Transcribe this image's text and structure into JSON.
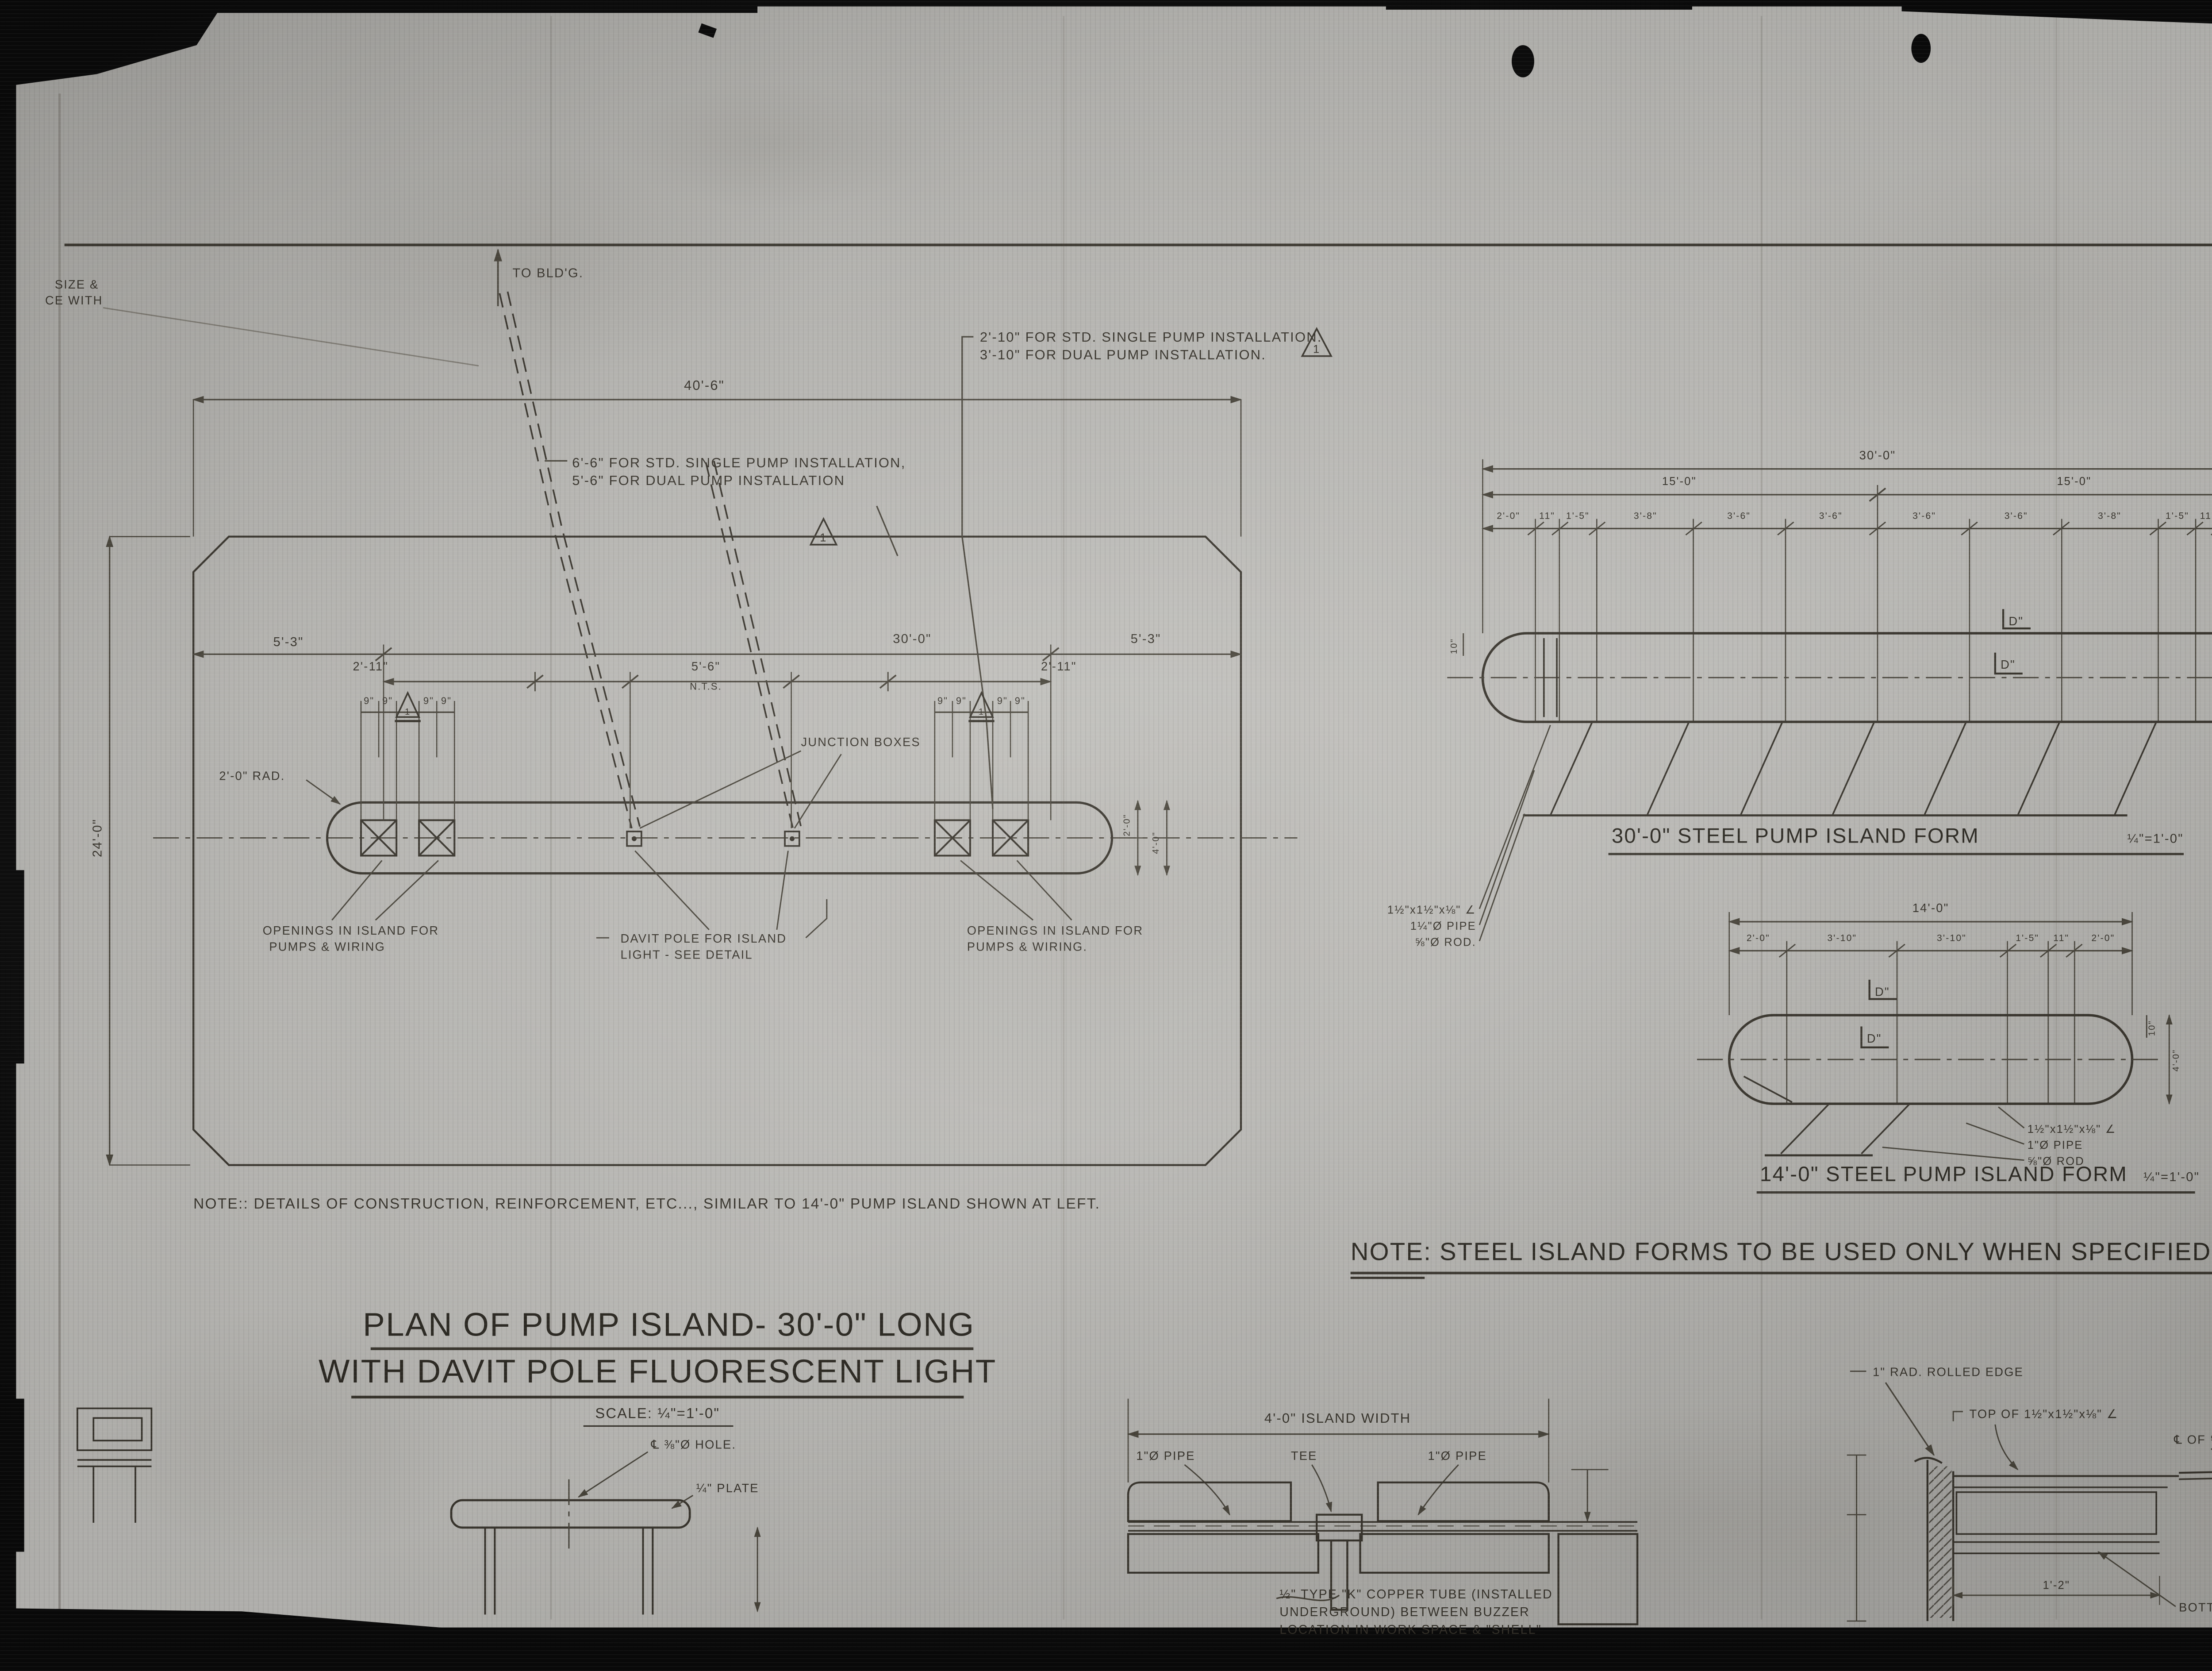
{
  "film": {
    "page_label": "2 of/de"
  },
  "margin_notes": {
    "cut_line1": "SIZE &",
    "cut_line2": "CE WITH",
    "to_building": "TO BLD'G."
  },
  "plan": {
    "annotations": {
      "pump_offset_top_line1": "2'-10\" FOR STD. SINGLE PUMP INSTALLATION.",
      "pump_offset_top_line2": "3'-10\" FOR DUAL PUMP INSTALLATION.",
      "pump_offset_left_line1": "6'-6\" FOR STD. SINGLE PUMP INSTALLATION,",
      "pump_offset_left_line2": "5'-6\" FOR DUAL PUMP INSTALLATION",
      "rev_triangle": "1",
      "junction_boxes": "JUNCTION BOXES",
      "davit_line1": "DAVIT POLE FOR ISLAND",
      "davit_line2": "LIGHT - SEE DETAIL",
      "openings_left_line1": "OPENINGS IN ISLAND FOR",
      "openings_left_line2": "PUMPS & WIRING",
      "openings_right_line1": "OPENINGS IN ISLAND FOR",
      "openings_right_line2": "PUMPS & WIRING.",
      "radius": "2'-0\" RAD."
    },
    "dims": {
      "overall": "40'-6\"",
      "left_end": "5'-3\"",
      "island_length": "30'-0\"",
      "right_end": "5'-3\"",
      "pump_left": "2'-11\"",
      "davit_spacing": "5'-6\"",
      "nts": "N.T.S.",
      "pump_right": "2'-11\"",
      "nine": "9\"",
      "depth": "24'-0\"",
      "island_half": "2'-0\"",
      "island_width": "4'-0\""
    },
    "note": "NOTE:: DETAILS OF CONSTRUCTION, REINFORCEMENT, ETC..., SIMILAR TO 14'-0\" PUMP ISLAND SHOWN AT LEFT.",
    "title_line1": "PLAN OF PUMP ISLAND- 30'-0\" LONG",
    "title_line2": "WITH DAVIT POLE FLUORESCENT LIGHT",
    "title_scale": "SCALE: ¼\"=1'-0\""
  },
  "form30": {
    "dims": {
      "total": "30'-0\"",
      "half_left": "15'-0\"",
      "half_right": "15'-0\"",
      "segs": [
        "2'-0\"",
        "11\"",
        "1'-5\"",
        "3'-8\"",
        "3'-6\"",
        "3'-6\"",
        "3'-6\"",
        "3'-6\"",
        "3'-8\"",
        "1'-5\"",
        "11\"",
        "2'-0\""
      ],
      "side_left": "10\"",
      "side_right": "10\"",
      "height": "4'-0\""
    },
    "section_mark": "D\"",
    "labels": {
      "angle": "1½\"x1½\"x⅛\" ∠",
      "pipe": "1¼\"Ø PIPE",
      "rod": "⅝\"Ø ROD."
    },
    "caption": "30'-0\" STEEL PUMP ISLAND FORM",
    "caption_scale": "¼\"=1'-0\""
  },
  "form14": {
    "dims": {
      "total": "14'-0\"",
      "segs": [
        "2'-0\"",
        "3'-10\"",
        "3'-10\"",
        "1'-5\"",
        "11\"",
        "2'-0\""
      ],
      "side_right": "10\"",
      "height": "4'-0\""
    },
    "section_mark": "D\"",
    "labels": {
      "angle": "1½\"x1½\"x⅛\" ∠",
      "pipe": "1\"Ø PIPE",
      "rod": "⅝\"Ø ROD"
    },
    "caption": "14'-0\" STEEL PUMP ISLAND FORM",
    "caption_scale": "¼\"=1'-0\""
  },
  "steel_note": "NOTE: STEEL ISLAND FORMS TO BE USED ONLY WHEN SPECIFIED.",
  "detail_pole": {
    "hole": "℄ ⅜\"Ø HOLE.",
    "plate": "¼\" PLATE"
  },
  "detail_section": {
    "width": "4'-0\" ISLAND WIDTH",
    "pipe_left": "1\"Ø PIPE",
    "tee": "TEE",
    "pipe_right": "1\"Ø PIPE",
    "note_line1": "½\" TYPE \"K\" COPPER TUBE (INSTALLED",
    "note_line2": "UNDERGROUND) BETWEEN BUZZER",
    "note_line3": "LOCATION IN WORK SPACE & \"SHELL\""
  },
  "detail_edge": {
    "rolled_edge": "1\" RAD. ROLLED EDGE",
    "top_of_angle": "TOP OF 1½\"x1½\"x⅛\" ∠",
    "rod_cl": "℄ OF ⅝\"Ø ROD.",
    "bottom_pipe": "BOTTOM OF 1¼\"Ø PIPE",
    "dim": "1'-2\""
  }
}
